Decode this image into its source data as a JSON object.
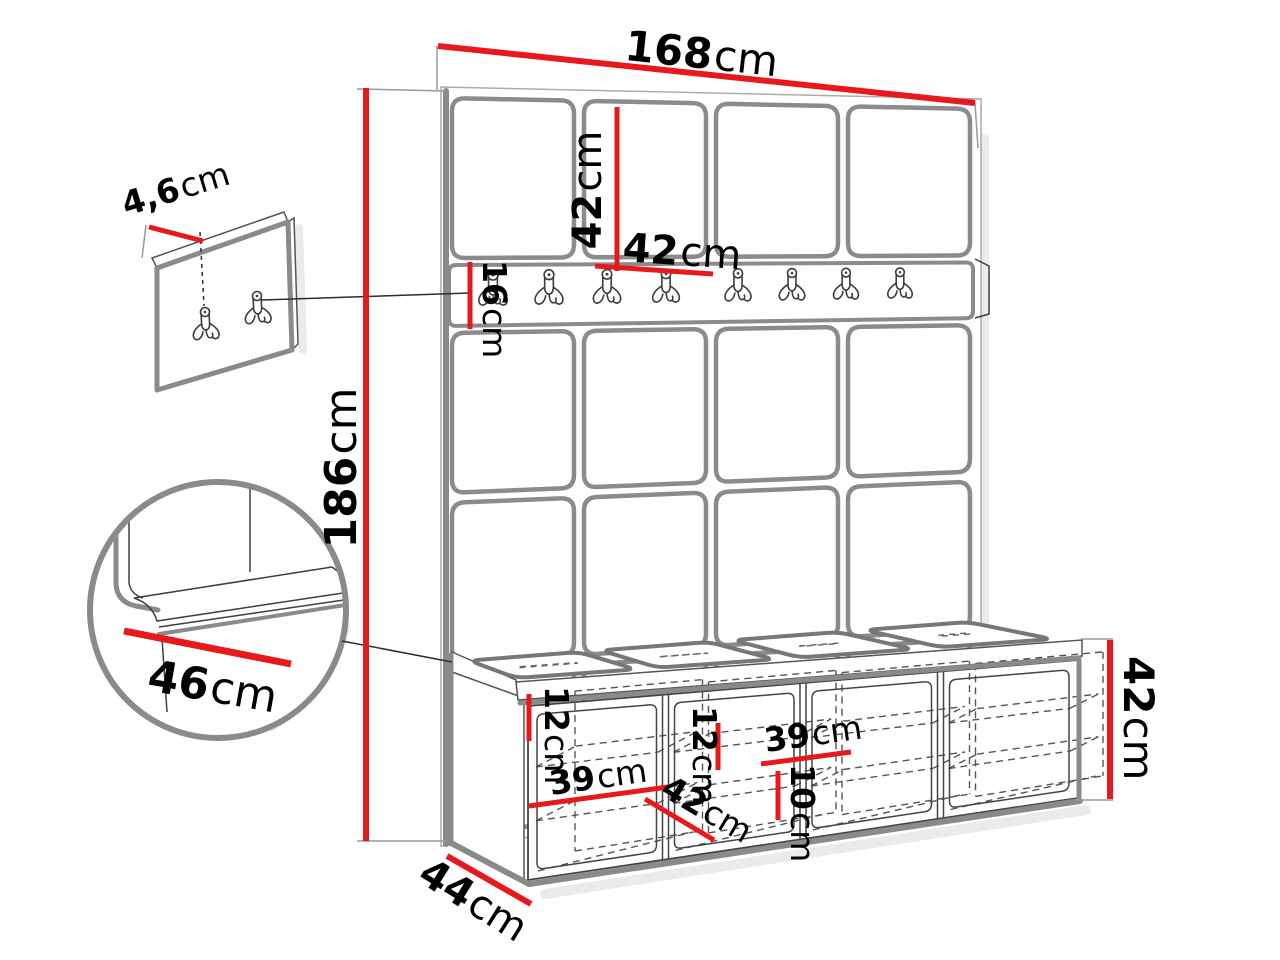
{
  "meta": {
    "type": "furniture-dimension-diagram",
    "units": "cm"
  },
  "colors": {
    "dimension_red": "#e8191d",
    "sketch_gray": "#8a8a8a",
    "text_black": "#000000",
    "background": "#ffffff"
  },
  "wall_unit": {
    "grid_columns": 4,
    "grid_rows": 4,
    "hook_count": 8,
    "total_width": {
      "value": "168",
      "unit": "cm"
    },
    "total_height": {
      "value": "186",
      "unit": "cm"
    },
    "panel_height": {
      "value": "42",
      "unit": "cm"
    },
    "panel_width": {
      "value": "42",
      "unit": "cm"
    },
    "rail_height": {
      "value": "16",
      "unit": "cm"
    }
  },
  "mounting_panel_detail": {
    "thickness": {
      "value": "4,6",
      "unit": "cm"
    }
  },
  "seat_detail": {
    "seat_depth": {
      "value": "46",
      "unit": "cm"
    }
  },
  "bench": {
    "compartments": 4,
    "depth": {
      "value": "44",
      "unit": "cm"
    },
    "height": {
      "value": "42",
      "unit": "cm"
    },
    "shelf_spacing_left": {
      "value": "12",
      "unit": "cm"
    },
    "shelf_width_left": {
      "value": "39",
      "unit": "cm"
    },
    "compartment_depth": {
      "value": "42",
      "unit": "cm"
    },
    "shelf_spacing_mid": {
      "value": "12",
      "unit": "cm"
    },
    "shelf_width_right": {
      "value": "39",
      "unit": "cm"
    },
    "plinth_height": {
      "value": "10",
      "unit": "cm"
    }
  }
}
